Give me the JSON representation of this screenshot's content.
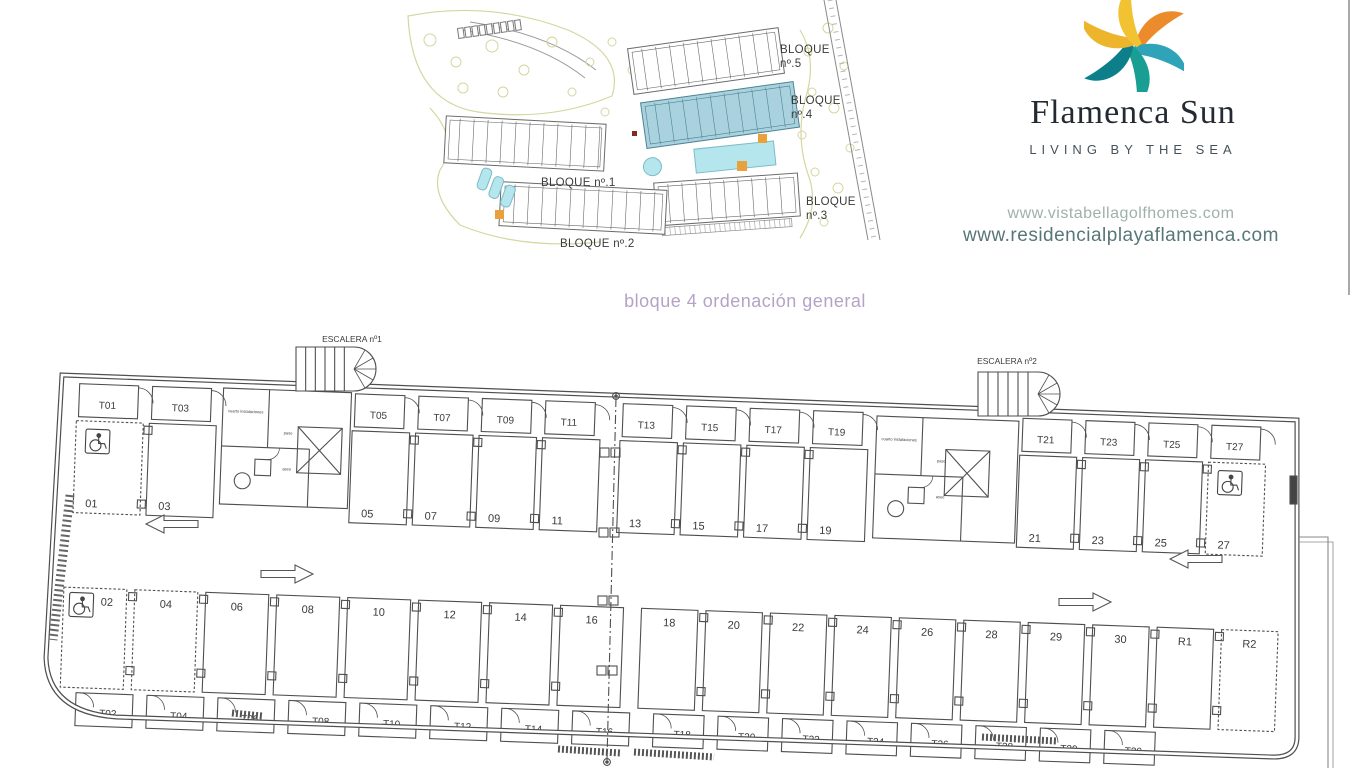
{
  "site_plan": {
    "blocks": [
      {
        "line1": "BLOQUE",
        "line2": "nº.5"
      },
      {
        "line1": "BLOQUE",
        "line2": "nº.4"
      },
      {
        "line1": "BLOQUE nº.1",
        "line2": ""
      },
      {
        "line1": "BLOQUE",
        "line2": "nº.3"
      },
      {
        "line1": "BLOQUE nº.2",
        "line2": ""
      }
    ],
    "highlight_color": "#a9d2de",
    "pool_color": "#b5e6ee",
    "accent_orange": "#e9a23b",
    "landscape_color": "#d5d6a0"
  },
  "brand": {
    "name": "Flamenca Sun",
    "tagline": "LIVING BY THE SEA",
    "urls": [
      "www.vistabellagolfhomes.com",
      "www.residencialplayaflamenca.com"
    ],
    "url_colors": {
      "primary": "#9fb0ad",
      "secondary": "#587678"
    },
    "logo_petal_colors": [
      "#ec8b2b",
      "#2fa3b7",
      "#189e92",
      "#0d7f8b",
      "#ecb52b",
      "#f1c232"
    ]
  },
  "drawing_title": {
    "text": "bloque 4 ordenación general",
    "color": "#b5a2c7"
  },
  "floor_plan": {
    "stair_labels": [
      "ESCALERA nº1",
      "ESCALERA nº2"
    ],
    "room_labels": [
      "cuarto instalaciones",
      "paso",
      "aseo"
    ],
    "top_row_left": [
      {
        "t": "T01",
        "s": "01",
        "dashed": true,
        "accessible": true
      },
      {
        "t": "T03",
        "s": "03"
      }
    ],
    "top_row_mid_a": [
      {
        "t": "T05",
        "s": "05"
      },
      {
        "t": "T07",
        "s": "07"
      },
      {
        "t": "T09",
        "s": "09"
      },
      {
        "t": "T11",
        "s": "11"
      }
    ],
    "top_row_mid_b": [
      {
        "t": "T13",
        "s": "13"
      },
      {
        "t": "T15",
        "s": "15"
      },
      {
        "t": "T17",
        "s": "17"
      },
      {
        "t": "T19",
        "s": "19"
      }
    ],
    "top_row_right": [
      {
        "t": "T21",
        "s": "21"
      },
      {
        "t": "T23",
        "s": "23"
      },
      {
        "t": "T25",
        "s": "25"
      },
      {
        "t": "T27",
        "s": "27",
        "dashed": true,
        "accessible": true
      }
    ],
    "bottom_row_left": [
      {
        "t": "T02",
        "s": "02",
        "dashed": true,
        "accessible": true
      },
      {
        "t": "T04",
        "s": "04",
        "dashed": true
      },
      {
        "t": "T06",
        "s": "06"
      },
      {
        "t": "T08",
        "s": "08"
      },
      {
        "t": "T10",
        "s": "10"
      },
      {
        "t": "T12",
        "s": "12"
      },
      {
        "t": "T14",
        "s": "14"
      },
      {
        "t": "T16",
        "s": "16"
      }
    ],
    "bottom_row_right": [
      {
        "t": "T18",
        "s": "18"
      },
      {
        "t": "T20",
        "s": "20"
      },
      {
        "t": "T22",
        "s": "22"
      },
      {
        "t": "T24",
        "s": "24"
      },
      {
        "t": "T26",
        "s": "26"
      },
      {
        "t": "T28",
        "s": "28"
      },
      {
        "t": "T29",
        "s": "29"
      },
      {
        "t": "T30",
        "s": "30"
      },
      {
        "s": "R1"
      },
      {
        "s": "R2",
        "dashed": true
      }
    ]
  }
}
